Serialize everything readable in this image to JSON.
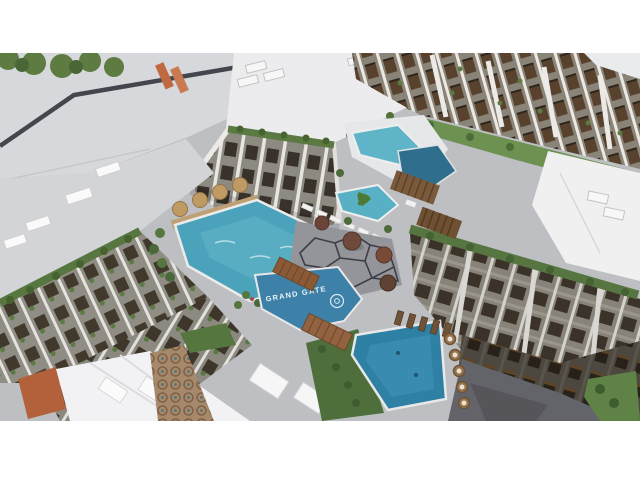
{
  "scene": {
    "sign_text": "GRAND GATE"
  },
  "palette": {
    "letterbox": "#ffffff",
    "roof_light": "#d7d8db",
    "roof_white": "#ececee",
    "facade_gray": "#8d8a81",
    "window_dark": "#39322a",
    "window_brown": "#58422e",
    "greenery": "#5a7a42",
    "lawn": "#6d9150",
    "pool_turquoise": "#4aa2bb",
    "pool_deep": "#2e80a4",
    "sign_panel": "#3d80a8",
    "wood_bridge": "#8a5a37",
    "terracotta": "#b2613b",
    "plaza_line": "#3e3f46"
  }
}
